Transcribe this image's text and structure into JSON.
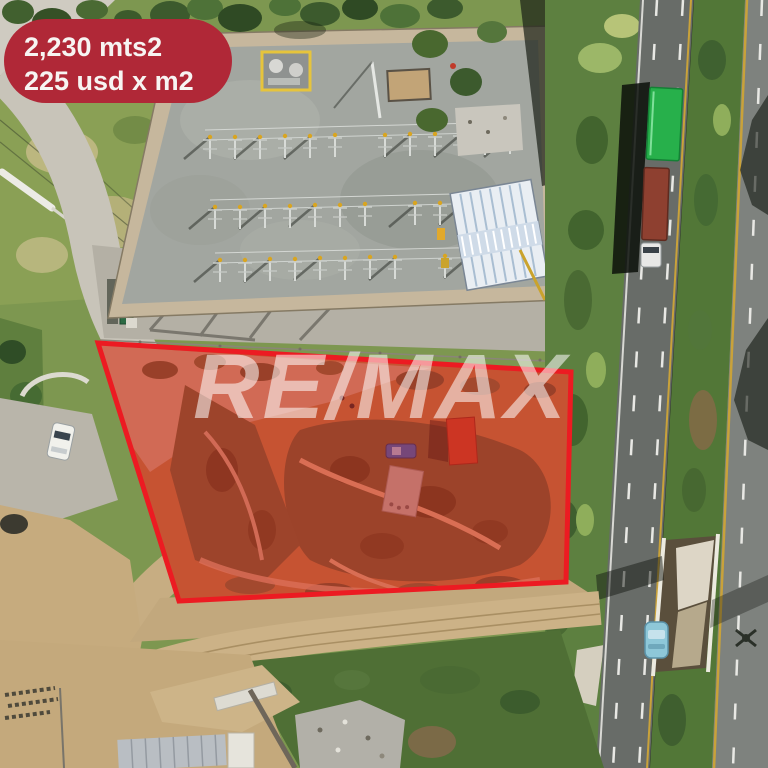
{
  "badge": {
    "line1": "2,230 mts2",
    "line2": "225 usd x m2",
    "bg_color": "#b02837",
    "text_color": "#f7f4f2"
  },
  "watermark": {
    "text": "RE/MAX",
    "color": "#ffffff"
  },
  "plot_highlight": {
    "outline_color": "#ec1b22",
    "fill_color": "rgba(224,30,32,0.40)"
  },
  "colors": {
    "truck_container_green": "#27b04b",
    "truck_container_red": "#8e4030",
    "highway_car_blue": "#8ec7d8",
    "plot_car_blue": "#2f63b4",
    "canopy_orange": "#bf4526",
    "asphalt_left": "#686c68",
    "asphalt_right": "#7e827e",
    "grass_strip": "#5d8040",
    "plot_dirt": "#b5773e"
  }
}
